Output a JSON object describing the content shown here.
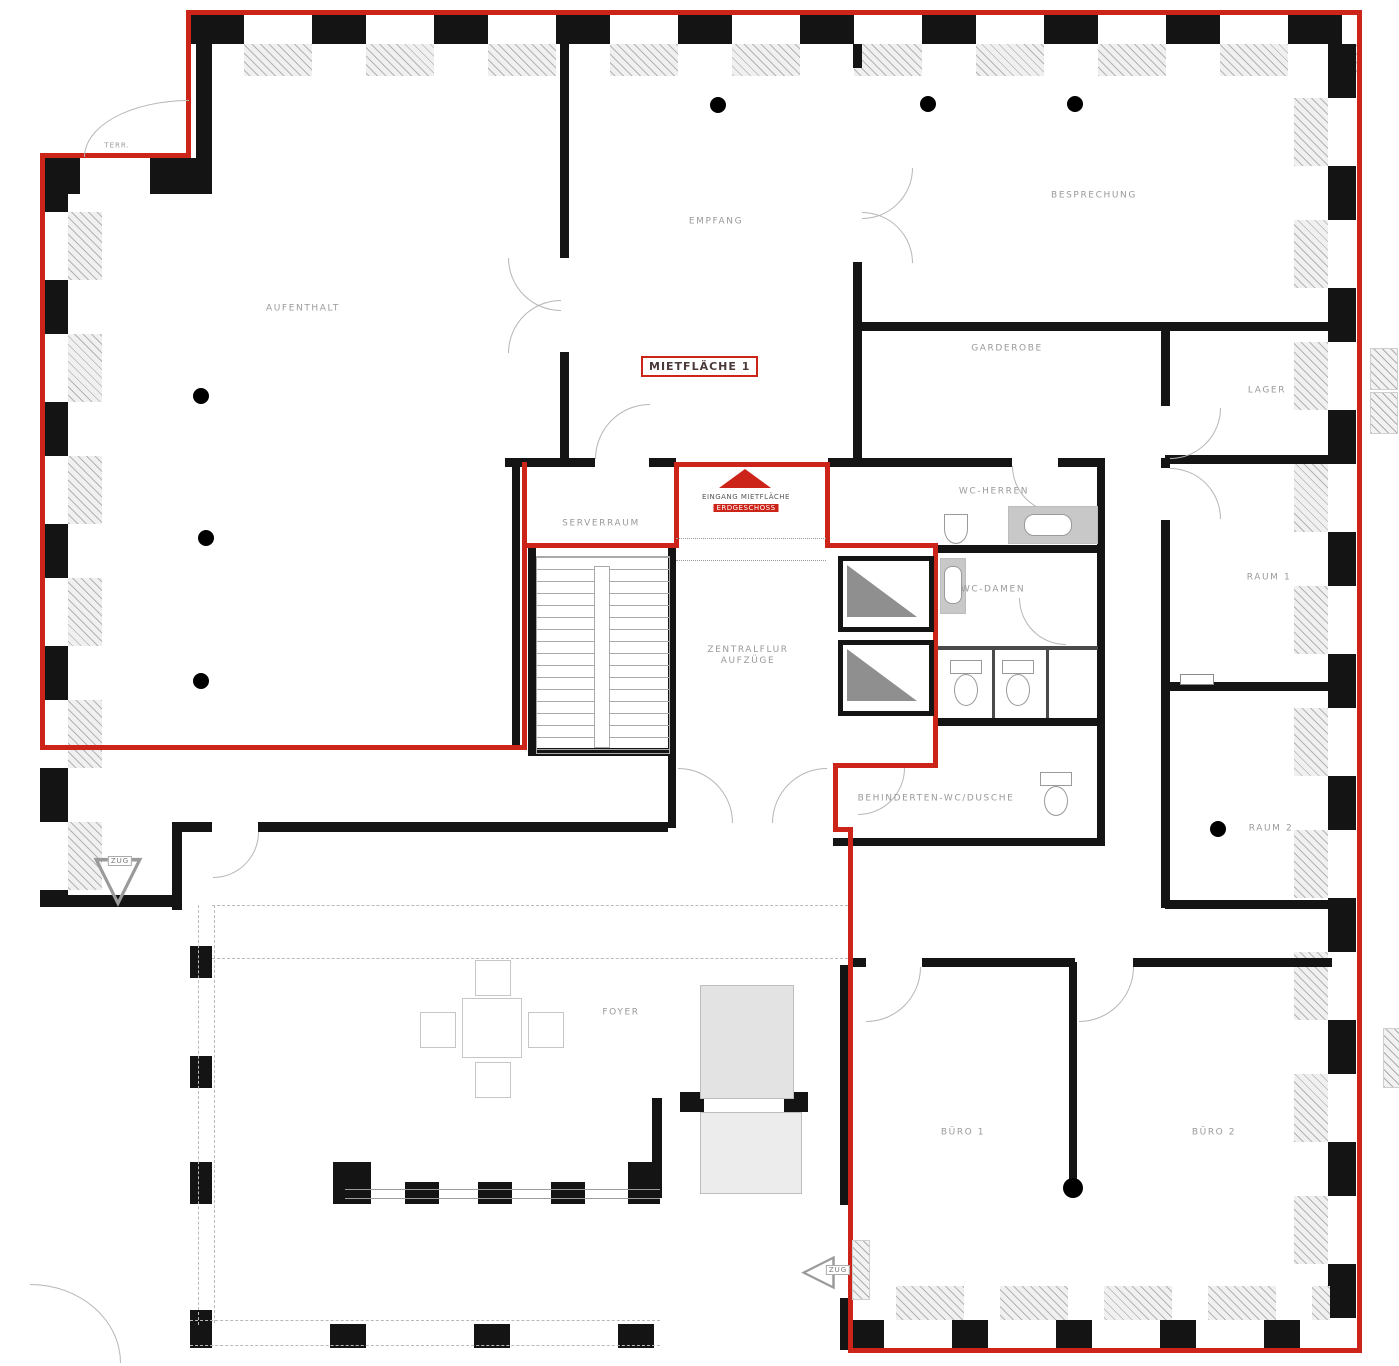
{
  "plan": {
    "area_box_label": "MIETFLÄCHE 1",
    "entrance": {
      "line1": "EINGANG MIETFLÄCHE",
      "line2": "ERDGESCHOSS"
    },
    "rooms": {
      "aufenthalt": "AUFENTHALT",
      "empfang": "EMPFANG",
      "besprechung": "BESPRECHUNG",
      "garderobe": "GARDEROBE",
      "lager": "LAGER",
      "raum1": "RAUM 1",
      "raum2": "RAUM 2",
      "serverraum": "SERVERRAUM",
      "zentralflur_line1": "ZENTRALFLUR",
      "zentralflur_line2": "AUFZÜGE",
      "wc_herren": "WC-HERREN",
      "wc_damen": "WC-DAMEN",
      "behinderten_wc": "BEHINDERTEN-WC/DUSCHE",
      "foyer": "FOYER",
      "buero1": "BÜRO 1",
      "buero2": "BÜRO 2"
    },
    "small_labels": {
      "terrace": "TERR.",
      "entry_left": "ZUG",
      "entry_bottom": "ZUG"
    },
    "colors": {
      "boundary_red": "#cc2418",
      "wall_black": "#141414",
      "label_gray": "#9a9a9a",
      "sill_fill": "#f0f0f0",
      "elevator_gray": "#8f8f8f"
    }
  }
}
